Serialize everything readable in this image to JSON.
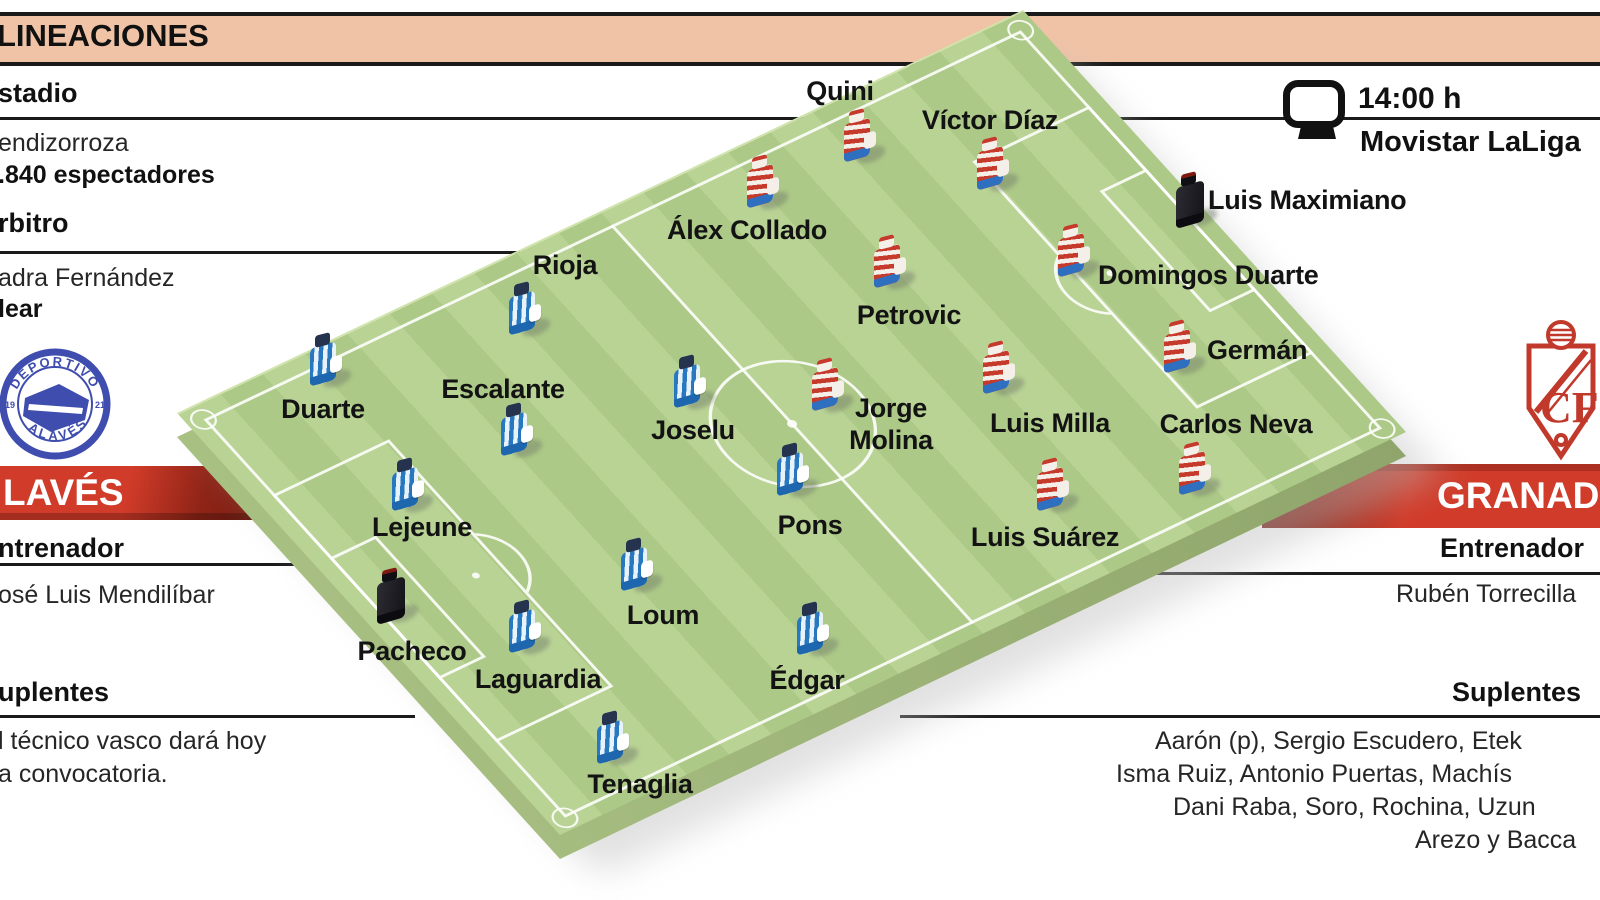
{
  "header": {
    "title": "LINEACIONES"
  },
  "match": {
    "kickoff_time": "14:00 h",
    "tv_channel": "Movistar LaLiga"
  },
  "left_panel": {
    "estadio_heading": "stadio",
    "estadio_name": "endizorroza",
    "estadio_capacity": ".840 espectadores",
    "arbitro_heading": "rbitro",
    "arbitro_name": "adra Fernández",
    "arbitro_region": "lear",
    "team_name": "LAVÉS",
    "entrenador_heading": "ntrenador",
    "entrenador_name": "osé Luis Mendilíbar",
    "suplentes_heading": "uplentes",
    "suplentes_lines": [
      "l técnico vasco dará hoy",
      "a convocatoria."
    ],
    "badge": {
      "top_text": "DEPORTIVO",
      "bottom_text": "ALAVÉS",
      "year_left": "19",
      "year_right": "21"
    }
  },
  "right_panel": {
    "team_name": "GRANADA",
    "entrenador_heading": "Entrenador",
    "entrenador_name": "Rubén Torrecilla",
    "suplentes_heading": "Suplentes",
    "suplentes_lines": [
      "Aarón (p), Sergio Escudero, Etek",
      "Isma Ruiz, Antonio Puertas, Machís",
      "Dani Raba, Soro, Rochina, Uzun",
      "Arezo y Bacca"
    ],
    "badge": {
      "monogram": "CF"
    }
  },
  "colors": {
    "band": "#f1c3a6",
    "bar_red": "#d13b29",
    "bar_red_dark": "#731c10",
    "pitch_light": "#b9d395",
    "pitch_dark": "#adc987",
    "alaves_blue": "#2878bf",
    "granada_red": "#c63a2c",
    "shorts_blue": "#2f6fc0",
    "badge_alaves_blue": "#3f4eae",
    "badge_granada_red": "#c0392b"
  },
  "players": [
    {
      "team": "granada",
      "gk": true,
      "name": "Luis Maximiano",
      "fig": [
        1192,
        202
      ],
      "label": [
        1208,
        200
      ],
      "anchor": "left"
    },
    {
      "team": "granada",
      "gk": false,
      "name": "Víctor Díaz",
      "fig": [
        993,
        167
      ],
      "label": [
        990,
        120
      ]
    },
    {
      "team": "granada",
      "gk": false,
      "name": "Quini",
      "fig": [
        860,
        139
      ],
      "label": [
        840,
        91
      ]
    },
    {
      "team": "granada",
      "gk": false,
      "name": "Domingos Duarte",
      "fig": [
        1074,
        254
      ],
      "label": [
        1098,
        275
      ],
      "anchor": "left"
    },
    {
      "team": "granada",
      "gk": false,
      "name": "Germán",
      "fig": [
        1180,
        350
      ],
      "label": [
        1207,
        350
      ],
      "anchor": "left"
    },
    {
      "team": "granada",
      "gk": false,
      "name": "Carlos Neva",
      "fig": [
        1195,
        472
      ],
      "label": [
        1236,
        424
      ]
    },
    {
      "team": "granada",
      "gk": false,
      "name": "Álex Collado",
      "fig": [
        763,
        185
      ],
      "label": [
        747,
        230
      ]
    },
    {
      "team": "granada",
      "gk": false,
      "name": "Petrovic",
      "fig": [
        890,
        265
      ],
      "label": [
        909,
        315
      ]
    },
    {
      "team": "granada",
      "gk": false,
      "name": "Luis Milla",
      "fig": [
        999,
        371
      ],
      "label": [
        1050,
        423
      ]
    },
    {
      "team": "granada",
      "gk": false,
      "name": "Jorge Molina",
      "fig": [
        828,
        388
      ],
      "label": [
        891,
        424
      ],
      "lines": [
        "Jorge",
        "Molina"
      ]
    },
    {
      "team": "granada",
      "gk": false,
      "name": "Luis Suárez",
      "fig": [
        1053,
        488
      ],
      "label": [
        1045,
        537
      ]
    },
    {
      "team": "alaves",
      "gk": true,
      "name": "Pacheco",
      "fig": [
        393,
        598
      ],
      "label": [
        412,
        651
      ]
    },
    {
      "team": "alaves",
      "gk": false,
      "name": "Duarte",
      "fig": [
        326,
        363
      ],
      "label": [
        323,
        409
      ]
    },
    {
      "team": "alaves",
      "gk": false,
      "name": "Lejeune",
      "fig": [
        408,
        488
      ],
      "label": [
        422,
        527
      ]
    },
    {
      "team": "alaves",
      "gk": false,
      "name": "Laguardia",
      "fig": [
        525,
        630
      ],
      "label": [
        538,
        679
      ]
    },
    {
      "team": "alaves",
      "gk": false,
      "name": "Tenaglia",
      "fig": [
        613,
        741
      ],
      "label": [
        640,
        784
      ]
    },
    {
      "team": "alaves",
      "gk": false,
      "name": "Rioja",
      "fig": [
        525,
        312
      ],
      "label": [
        565,
        265
      ]
    },
    {
      "team": "alaves",
      "gk": false,
      "name": "Escalante",
      "fig": [
        517,
        433
      ],
      "label": [
        503,
        389
      ]
    },
    {
      "team": "alaves",
      "gk": false,
      "name": "Loum",
      "fig": [
        637,
        568
      ],
      "label": [
        663,
        615
      ]
    },
    {
      "team": "alaves",
      "gk": false,
      "name": "Joselu",
      "fig": [
        690,
        385
      ],
      "label": [
        693,
        430
      ]
    },
    {
      "team": "alaves",
      "gk": false,
      "name": "Pons",
      "fig": [
        793,
        473
      ],
      "label": [
        810,
        525
      ]
    },
    {
      "team": "alaves",
      "gk": false,
      "name": "Édgar",
      "fig": [
        813,
        632
      ],
      "label": [
        807,
        680
      ]
    }
  ]
}
